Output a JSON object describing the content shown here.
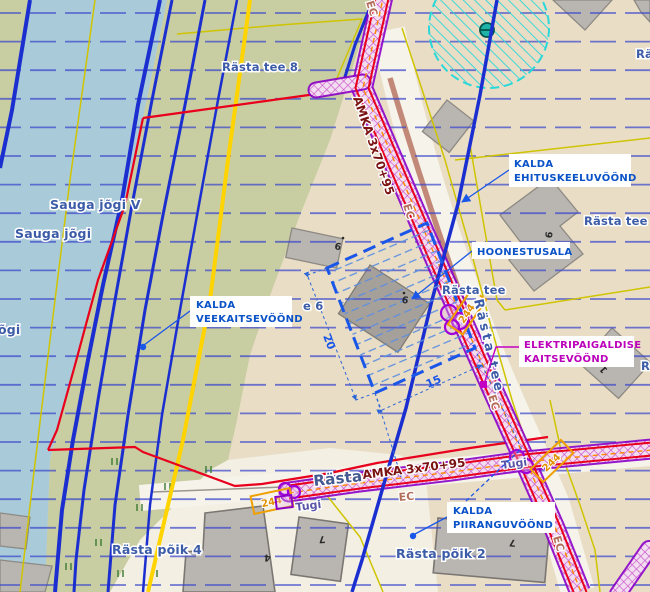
{
  "map": {
    "region_labels": {
      "ehituskeelu_1": "KALDA",
      "ehituskeelu_2": "EHITUSKEELUVÖÖND",
      "hoonestusala": "HOONESTUSALA",
      "veekaitse_1": "KALDA",
      "veekaitse_2": "VEEKAITSEVÖÖND",
      "elektri_1": "ELEKTRIPAIGALDISE",
      "elektri_2": "KAITSEVÖÖND",
      "piirangu_1": "KALDA",
      "piirangu_2": "PIIRANGUVÖÖND"
    },
    "streets": {
      "rasta_tee_8": "Rästa tee 8",
      "rasta_tee_9": "Rästa tee 9",
      "rasta_tee_6_partial": "e 6",
      "rasta_tee": "Rästa tee",
      "rasta": "Rästa",
      "rasta_poik_4": "Rästa põik 4",
      "rasta_poik_2": "Rästa põik 2",
      "ra_partial": "Rä",
      "r_partial": "R"
    },
    "water": {
      "sauga_jogi": "Sauga jõgi",
      "sauga_jogi_v": "Sauga jõgi V",
      "jogi_partial": "õgi"
    },
    "cable": {
      "amka": "AMKA 3x70+95",
      "ec": "EC",
      "tugi": "Tugi",
      "pole_244": "244"
    },
    "dimensions": {
      "d20": "20",
      "d15": "15"
    },
    "house_numbers": {
      "n6": "6",
      "n9": "9",
      "n4": "4",
      "n7": "7",
      "n1": "1"
    },
    "colors": {
      "water": "#a9cbd9",
      "land_green": "#c9cda2",
      "land_beige": "#e9ddc6",
      "land_cream": "#f3efe3",
      "cable_zone_magenta": "#c84fc8",
      "boundary_red": "#e8001c",
      "contour_blue": "#1b2fd0",
      "cadastral_yellow": "#ffd400",
      "label_blue": "#0a52c8",
      "label_magenta": "#bb00bb",
      "restriction_cyan": "#2ad8d8"
    }
  }
}
